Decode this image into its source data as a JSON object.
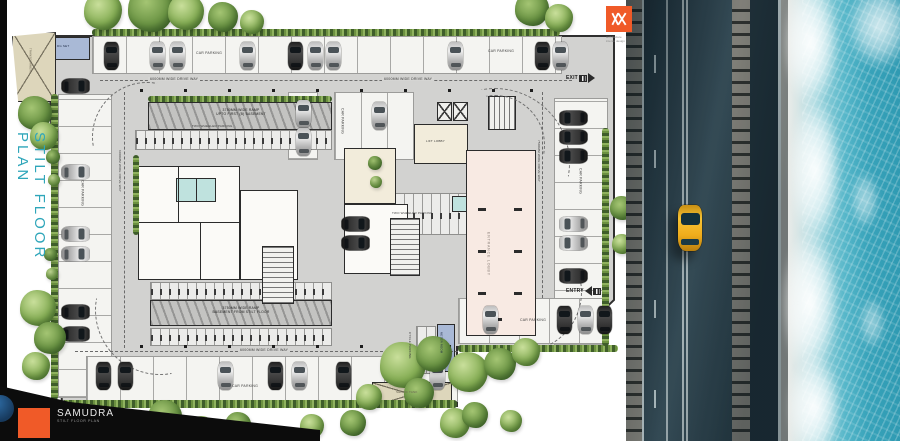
{
  "page": {
    "background": "#ffffff"
  },
  "title": {
    "text": "STILT FLOOR PLAN",
    "color": "#2fa6ba"
  },
  "architect_logo": {
    "tagline_line1": "architecture",
    "tagline_line2": "interior design",
    "color": "#f05a28"
  },
  "project_logo": {
    "name": "SAMUDRA",
    "subtitle": "STILT FLOOR PLAN",
    "color": "#f05a28"
  },
  "plan": {
    "labels": {
      "car_parking": "CAR PARKING",
      "two_wheeler_parking": "TWO WHEELER PARKING",
      "cycle_parking": "CYCLE PARKING",
      "drive_way": "6000MM WIDE DRIVE WAY",
      "drive_way_right": "7500MM WIDE DRIVE WAY",
      "ramp_upper_line1": "3750MM WIDE RAMP",
      "ramp_upper_line2": "UPTO FIRST (B) BASEMENT",
      "ramp_lower_line1": "3750MM WIDE RAMP",
      "ramp_lower_line2": "BASEMENT FROM STILT FLOOR",
      "exit": "EXIT",
      "entry": "ENTRY",
      "lift_lobby": "LIFT LOBBY",
      "entrance_lobby": "ENTRANCE LOBBY",
      "meter_room": "METER ROOM",
      "transformer": "TRANSFORMER",
      "dg_set": "DG SET",
      "septic_tank": "SEPTIC TANK"
    }
  },
  "scene": {
    "road_car_color": "#f2b01e",
    "ocean_color": "#3fa5bd",
    "greenery_color": "#6b9444"
  }
}
